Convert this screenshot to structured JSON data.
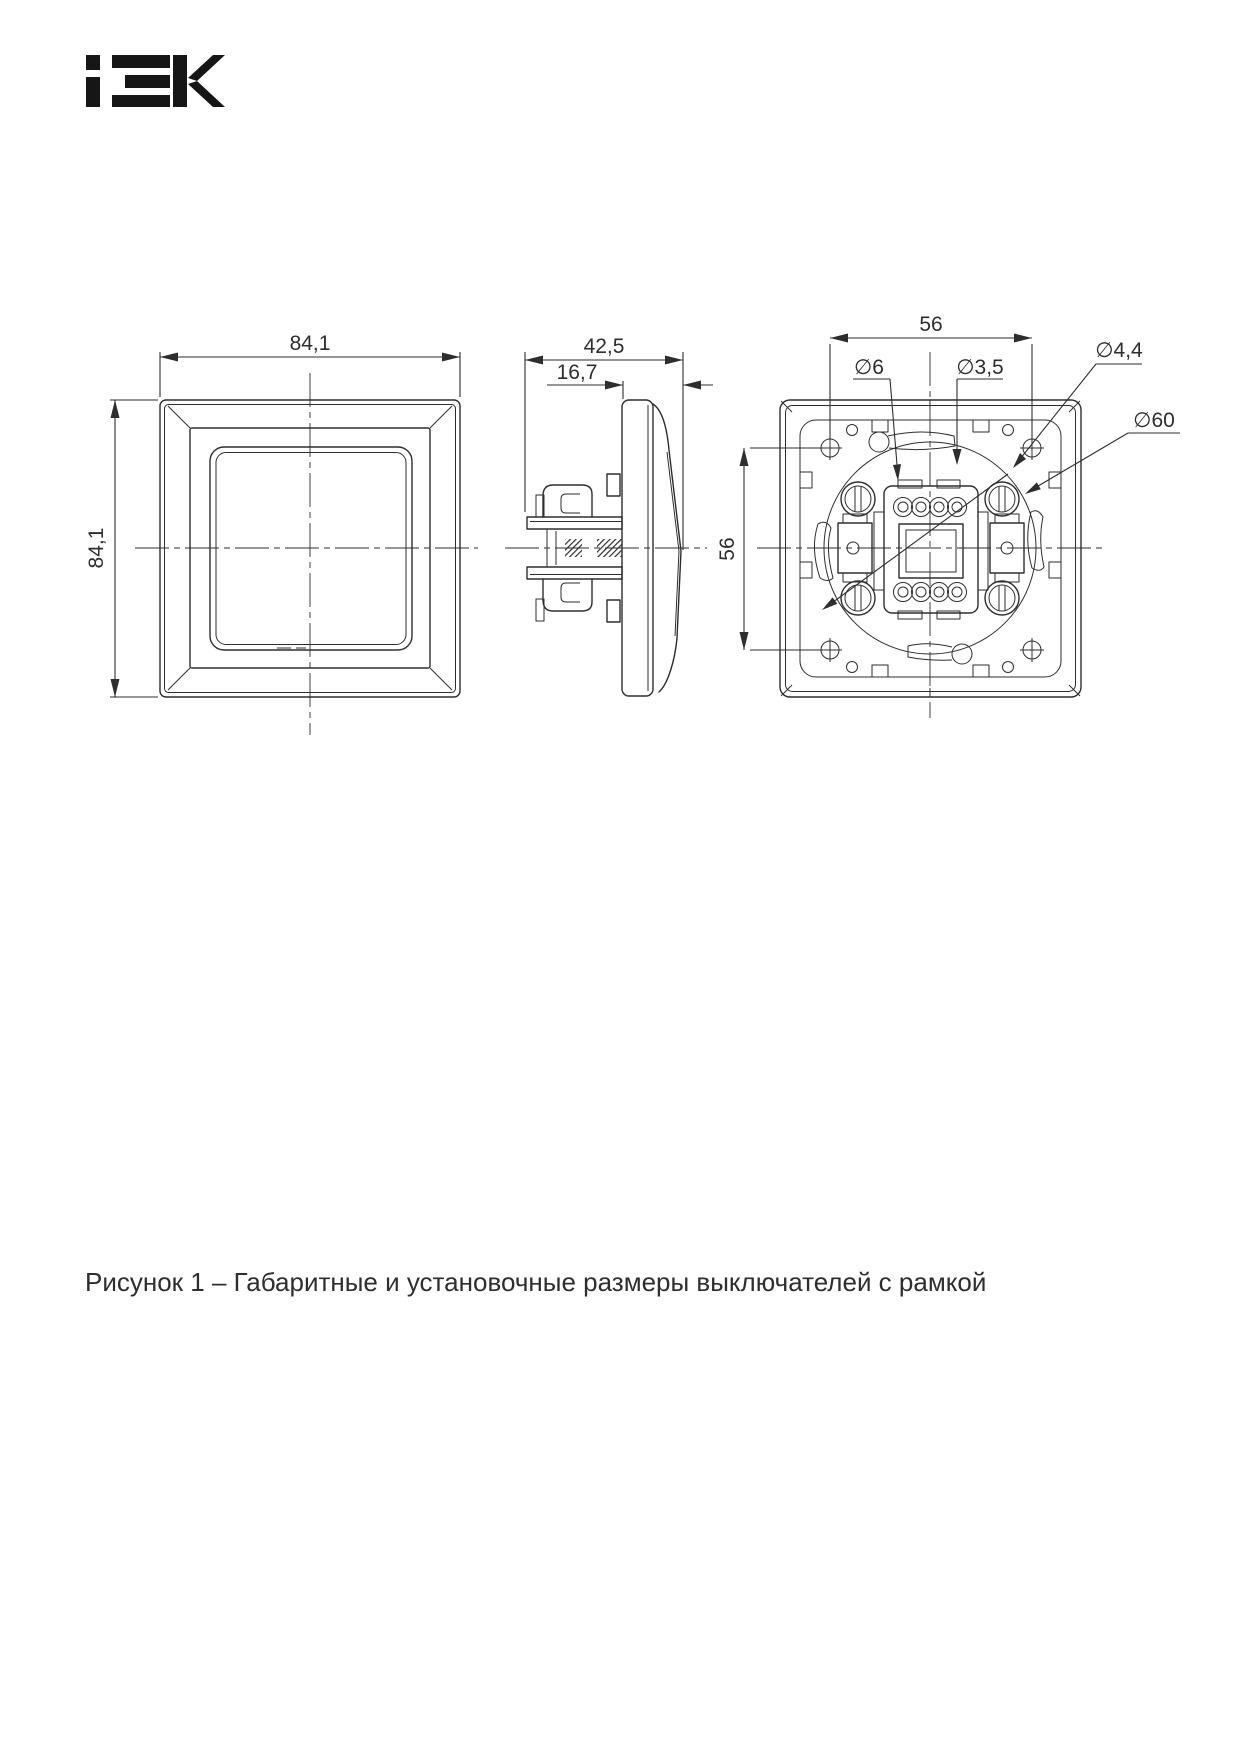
{
  "colors": {
    "ink": "#2e2e2e",
    "logo": "#161616",
    "background": "#ffffff"
  },
  "brand": {
    "name": "IEK"
  },
  "figure": {
    "caption": "Рисунок 1 – Габаритные и установочные размеры выключателей с рамкой"
  },
  "front_view": {
    "width": "84,1",
    "height": "84,1"
  },
  "side_view": {
    "total_depth": "42,5",
    "protruding_depth": "16,7"
  },
  "back_view": {
    "holes_spacing_horizontal": "56",
    "holes_spacing_vertical": "56",
    "dia_frame_hole": "∅6",
    "dia_screw_hole": "∅3,5",
    "dia_claw_screw_hole": "∅4,4",
    "dia_mounting_circle": "∅60"
  }
}
